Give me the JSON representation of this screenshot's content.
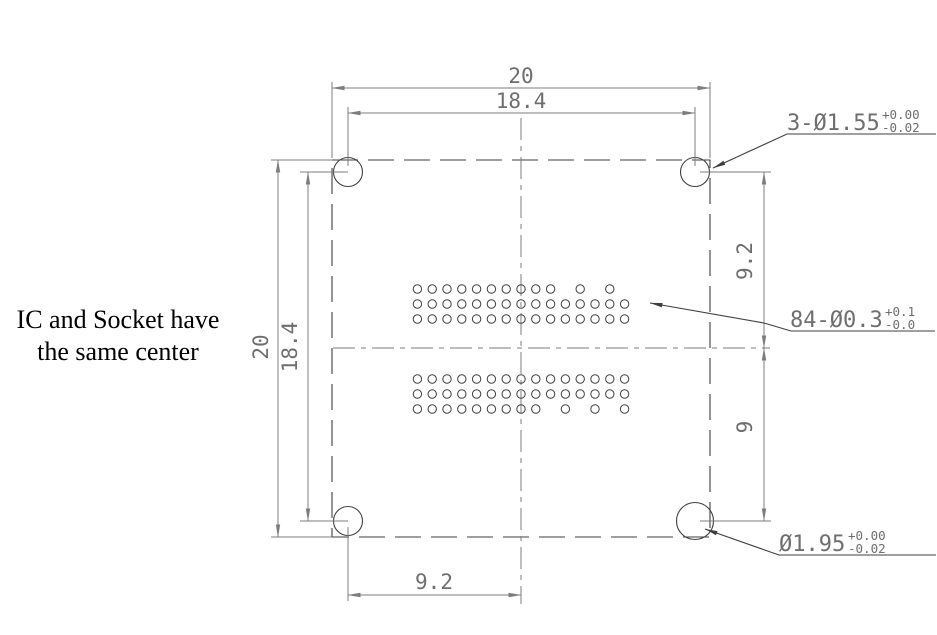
{
  "note": {
    "line1": "IC and Socket have",
    "line2": "the same center"
  },
  "dimensions": {
    "top_overall": "20",
    "top_hole_spacing": "18.4",
    "left_overall": "20",
    "left_hole_spacing": "18.4",
    "right_upper": "9.2",
    "right_lower": "9",
    "bottom_half": "9.2"
  },
  "callouts": {
    "corner_holes": {
      "text": "3-Ø1.55",
      "tol_plus": "+0.00",
      "tol_minus": "-0.02"
    },
    "pin_holes": {
      "text": "84-Ø0.3",
      "tol_plus": "+0.1",
      "tol_minus": "-0.0"
    },
    "pin1_hole": {
      "text": "Ø1.95",
      "tol_plus": "+0.00",
      "tol_minus": "-0.02"
    }
  },
  "pin_grid": {
    "total_holes": 84,
    "columns": 15,
    "rows_per_block": 3,
    "upper_block_missing_top_row_cols": [
      11,
      13,
      15
    ],
    "lower_block_missing_bottom_row_cols": [
      10,
      12,
      14
    ]
  },
  "colors": {
    "background": "#ffffff",
    "object_line": "#3f3f3f",
    "dim_line": "#7d7d7d",
    "dim_text": "#6e6e6e",
    "note_text": "#000000"
  }
}
